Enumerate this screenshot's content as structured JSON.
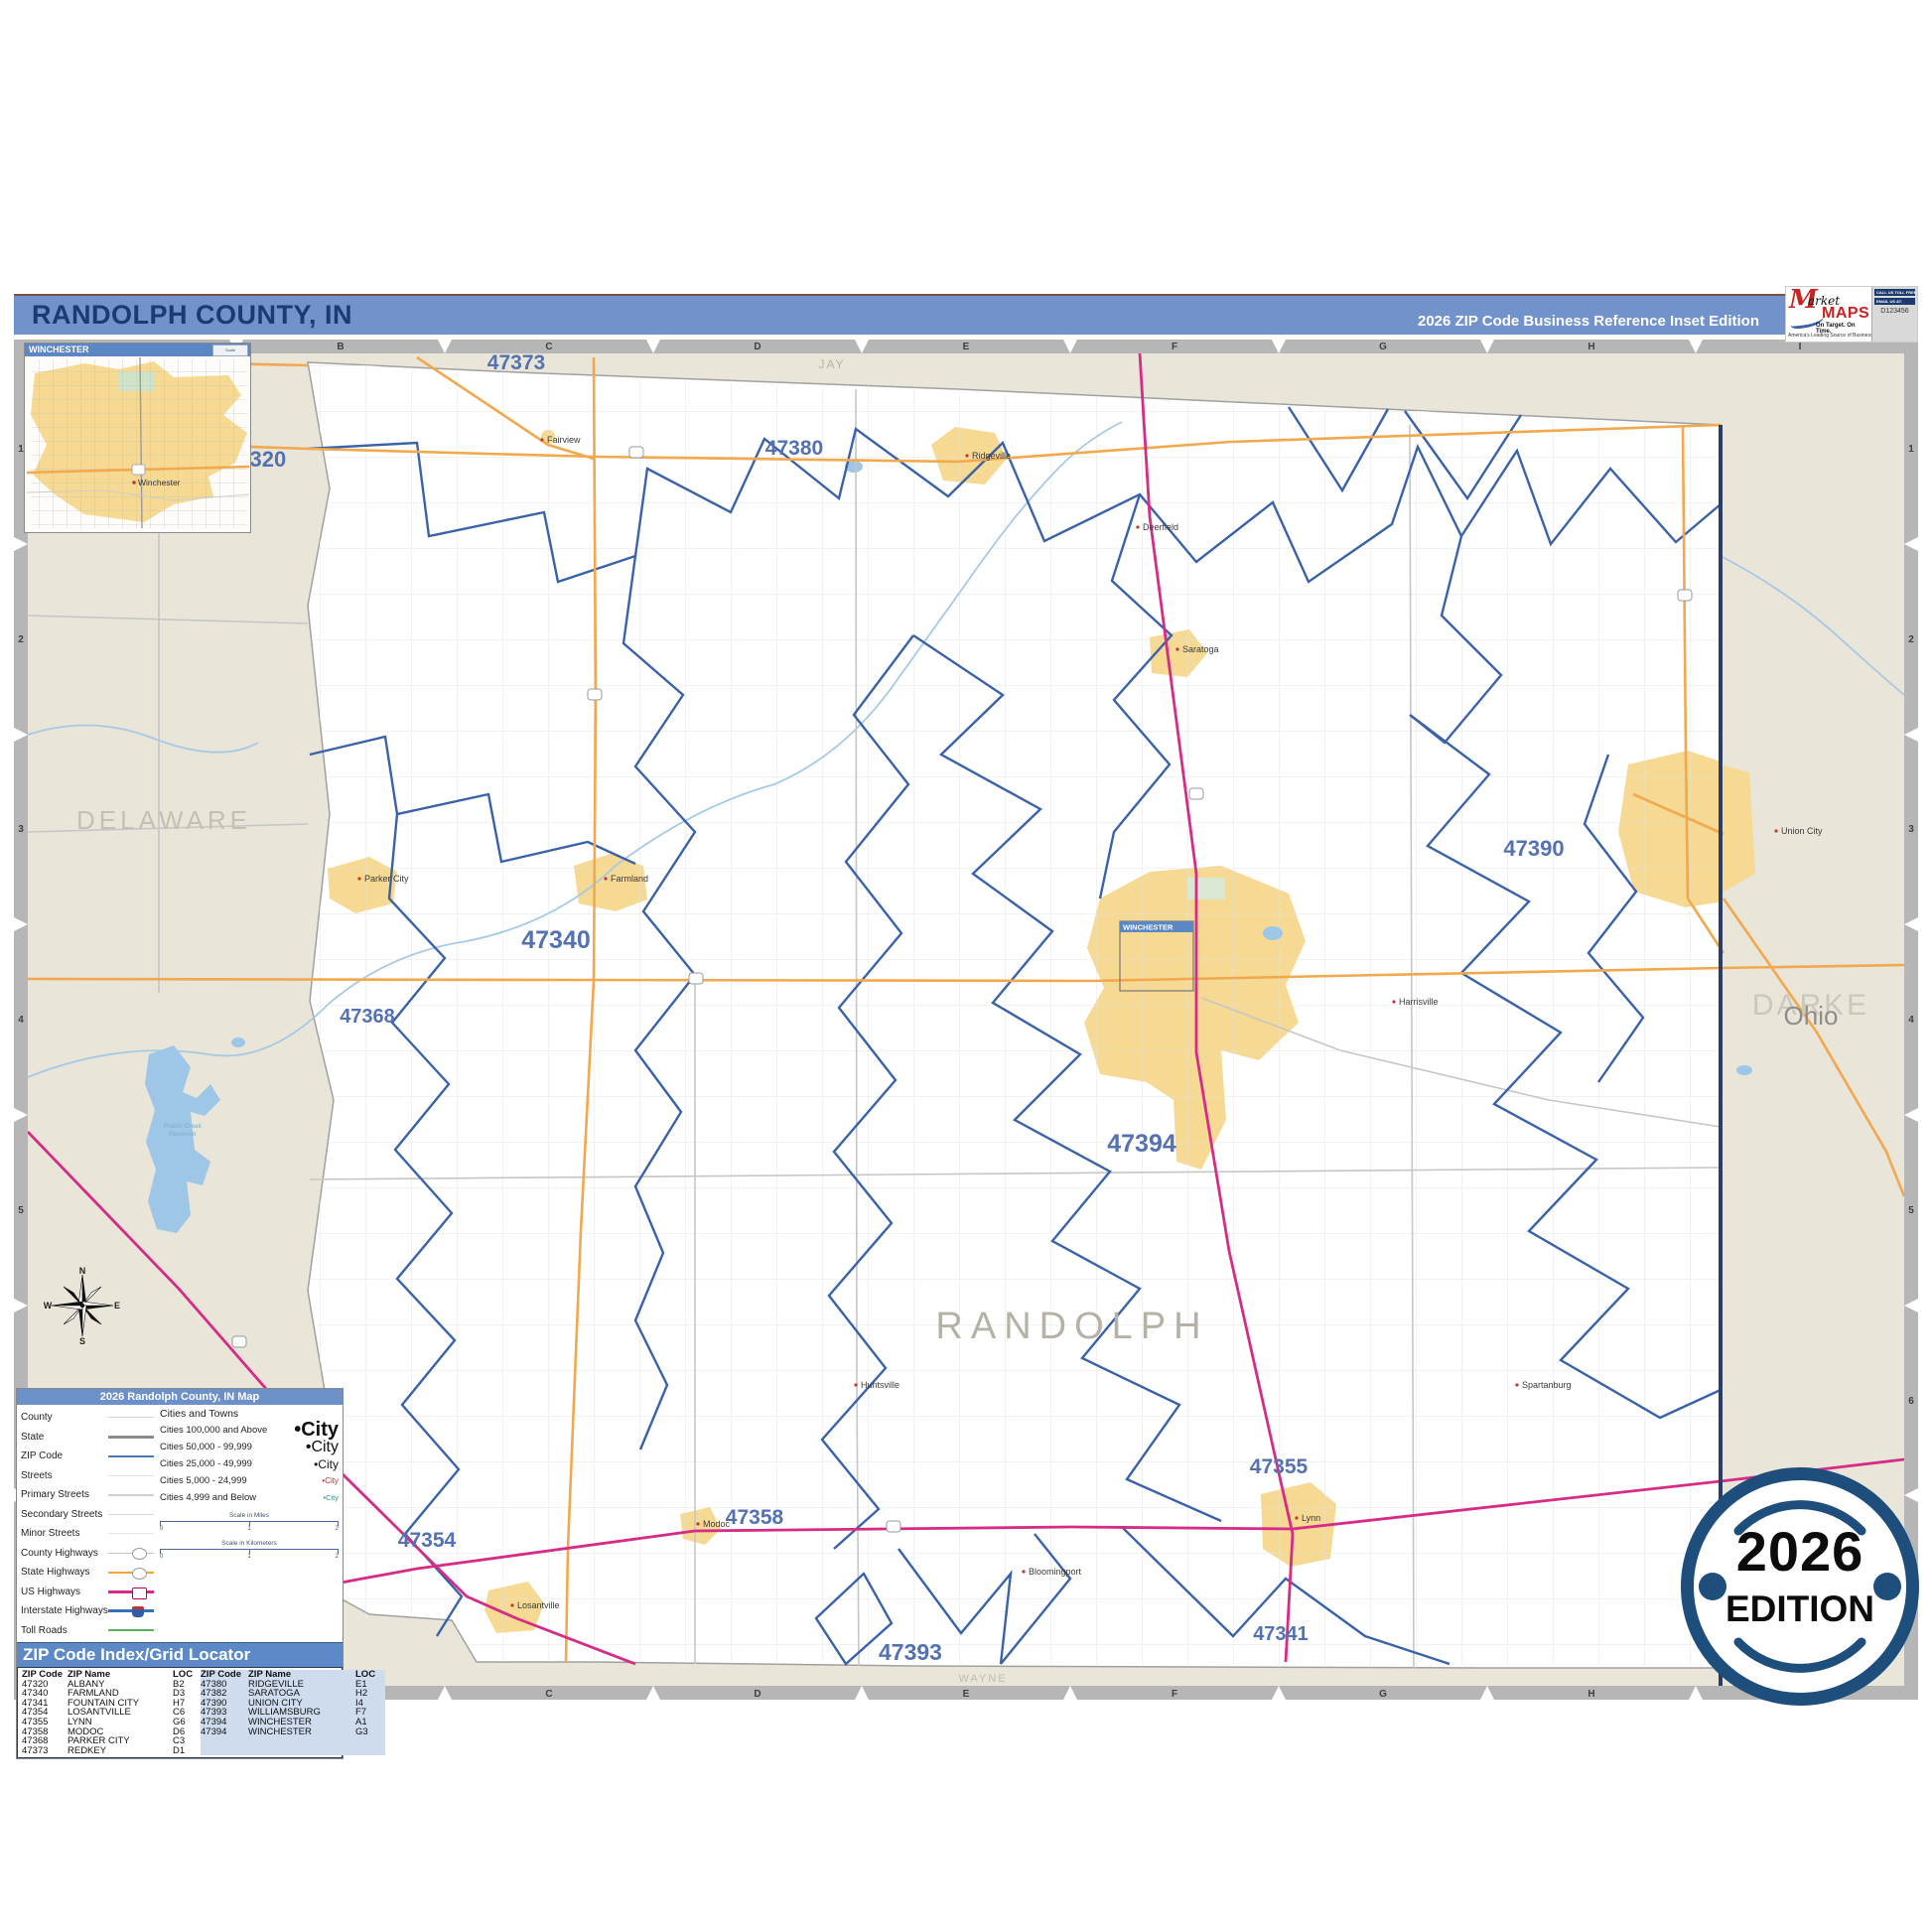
{
  "header": {
    "title": "RANDOLPH COUNTY, IN",
    "edition": "2026 ZIP Code Business Reference Inset Edition"
  },
  "logo": {
    "market_m": "M",
    "market_rest": "arket",
    "maps": "MAPS",
    "tagline": "On Target. On Time.",
    "subline": "America's Leading Source of Business Maps",
    "contact_top": "CALL US TOLL FREE",
    "contact_mid": "EMAIL US AT:",
    "code": "D123456"
  },
  "inset": {
    "title": "WINCHESTER",
    "city": "Winchester",
    "scale_note": "Scale"
  },
  "grid": {
    "letters": [
      "A",
      "B",
      "C",
      "D",
      "E",
      "F",
      "G",
      "H",
      "I"
    ],
    "numbers": [
      "1",
      "2",
      "3",
      "4",
      "5",
      "6",
      "7"
    ]
  },
  "compass": {
    "n": "N",
    "e": "E",
    "s": "S",
    "w": "W"
  },
  "map": {
    "locator_title": "WINCHESTER",
    "county_labels": {
      "jay": "JAY",
      "delaware": "DELAWARE",
      "randolph": "RANDOLPH",
      "darke": "DARKE",
      "ohio": "Ohio",
      "wayne": "WAYNE"
    },
    "reservoir": [
      "Prairie Creek",
      "Reservoir"
    ],
    "zip_labels": [
      {
        "code": "47320"
      },
      {
        "code": "47373"
      },
      {
        "code": "47380"
      },
      {
        "code": "47340"
      },
      {
        "code": "47368"
      },
      {
        "code": "47390"
      },
      {
        "code": "47394"
      },
      {
        "code": "47358"
      },
      {
        "code": "47354"
      },
      {
        "code": "47355"
      },
      {
        "code": "47341"
      },
      {
        "code": "47393"
      }
    ],
    "towns": [
      "Fairview",
      "Ridgeville",
      "Deerfield",
      "Saratoga",
      "Union City",
      "Farmland",
      "Parker City",
      "Harrisville",
      "Huntsville",
      "Modoc",
      "Losantville",
      "Lynn",
      "Bloomingport",
      "Spartanburg"
    ]
  },
  "legend": {
    "title": "2026 Randolph County, IN Map",
    "items": [
      "County",
      "State",
      "ZIP Code",
      "Streets",
      "Primary Streets",
      "Secondary Streets",
      "Minor Streets",
      "County Highways",
      "State Highways",
      "US Highways",
      "Interstate Highways",
      "Toll Roads"
    ],
    "cities_header": "Cities and Towns",
    "city_classes": [
      {
        "label": "Cities 100,000 and Above",
        "sample": "City"
      },
      {
        "label": "Cities 50,000 - 99,999",
        "sample": "City"
      },
      {
        "label": "Cities 25,000 - 49,999",
        "sample": "City"
      },
      {
        "label": "Cities 5,000 - 24,999",
        "sample": "City"
      },
      {
        "label": "Cities 4,999 and Below",
        "sample": "City"
      }
    ],
    "scale_miles": "Scale in Miles",
    "scale_km": "Scale in Kilometers",
    "ticks": [
      "0",
      "1",
      "2"
    ]
  },
  "index": {
    "title": "ZIP Code Index/Grid Locator",
    "headers": [
      "ZIP Code",
      "ZIP Name",
      "LOC"
    ],
    "rows_left": [
      [
        "47320",
        "ALBANY",
        "B2"
      ],
      [
        "47340",
        "FARMLAND",
        "D3"
      ],
      [
        "47341",
        "FOUNTAIN CITY",
        "H7"
      ],
      [
        "47354",
        "LOSANTVILLE",
        "C6"
      ],
      [
        "47355",
        "LYNN",
        "G6"
      ],
      [
        "47358",
        "MODOC",
        "D6"
      ],
      [
        "47368",
        "PARKER CITY",
        "C3"
      ],
      [
        "47373",
        "REDKEY",
        "D1"
      ]
    ],
    "rows_right": [
      [
        "47380",
        "RIDGEVILLE",
        "E1"
      ],
      [
        "47382",
        "SARATOGA",
        "H2"
      ],
      [
        "47390",
        "UNION CITY",
        "I4"
      ],
      [
        "47393",
        "WILLIAMSBURG",
        "F7"
      ],
      [
        "47394",
        "WINCHESTER",
        "A1"
      ],
      [
        "47394",
        "WINCHESTER",
        "G3"
      ]
    ]
  },
  "badge": {
    "year": "2026",
    "label": "EDITION"
  }
}
